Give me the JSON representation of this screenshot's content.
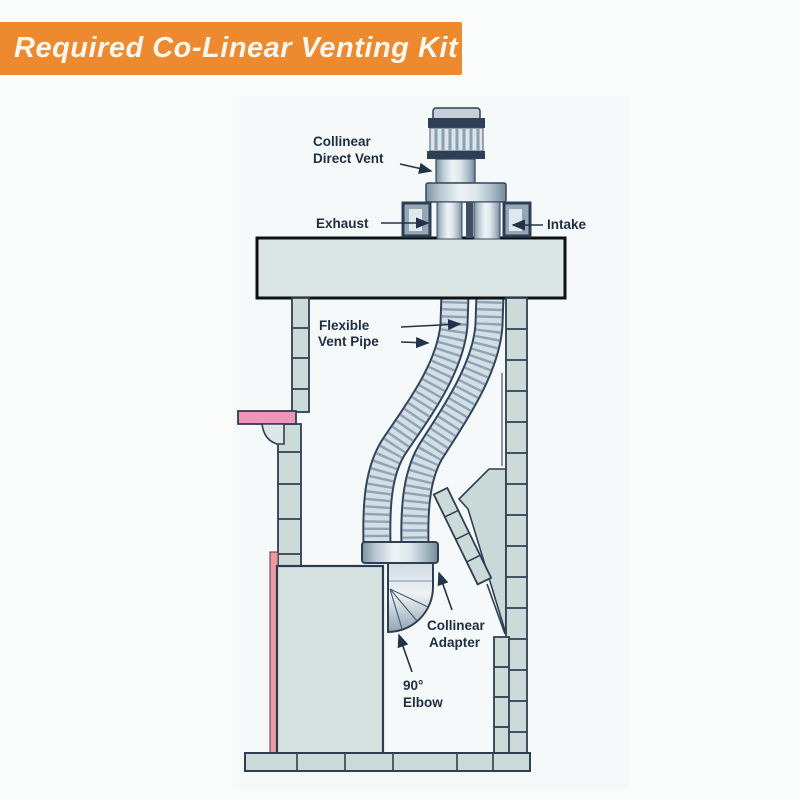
{
  "banner": {
    "title": "Required Co-Linear Venting Kit",
    "bg_color": "#ED8A2F",
    "text_color": "#FCF7EE"
  },
  "diagram": {
    "description": "Cross-section of a masonry chimney fireplace with co-linear direct venting kit",
    "labels": {
      "collinear_direct_vent_1": "Collinear",
      "collinear_direct_vent_2": "Direct Vent",
      "exhaust": "Exhaust",
      "intake": "Intake",
      "flexible_vent_pipe_1": "Flexible",
      "flexible_vent_pipe_2": "Vent Pipe",
      "collinear_adapter_1": "Collinear",
      "collinear_adapter_2": "Adapter",
      "elbow_1": "90°",
      "elbow_2": "Elbow"
    },
    "colors": {
      "outline": "#2E3E54",
      "masonry_fill": "#CCDBD8",
      "crown_fill": "#DBE5E3",
      "firebox_fill": "#D6E1DF",
      "mantel_pink": "#F094B8",
      "strip_pink": "#EB9AA2",
      "label_text": "#1F2D42",
      "metal_dark": "#7D92A2",
      "metal_light": "#EEF3F6"
    }
  }
}
